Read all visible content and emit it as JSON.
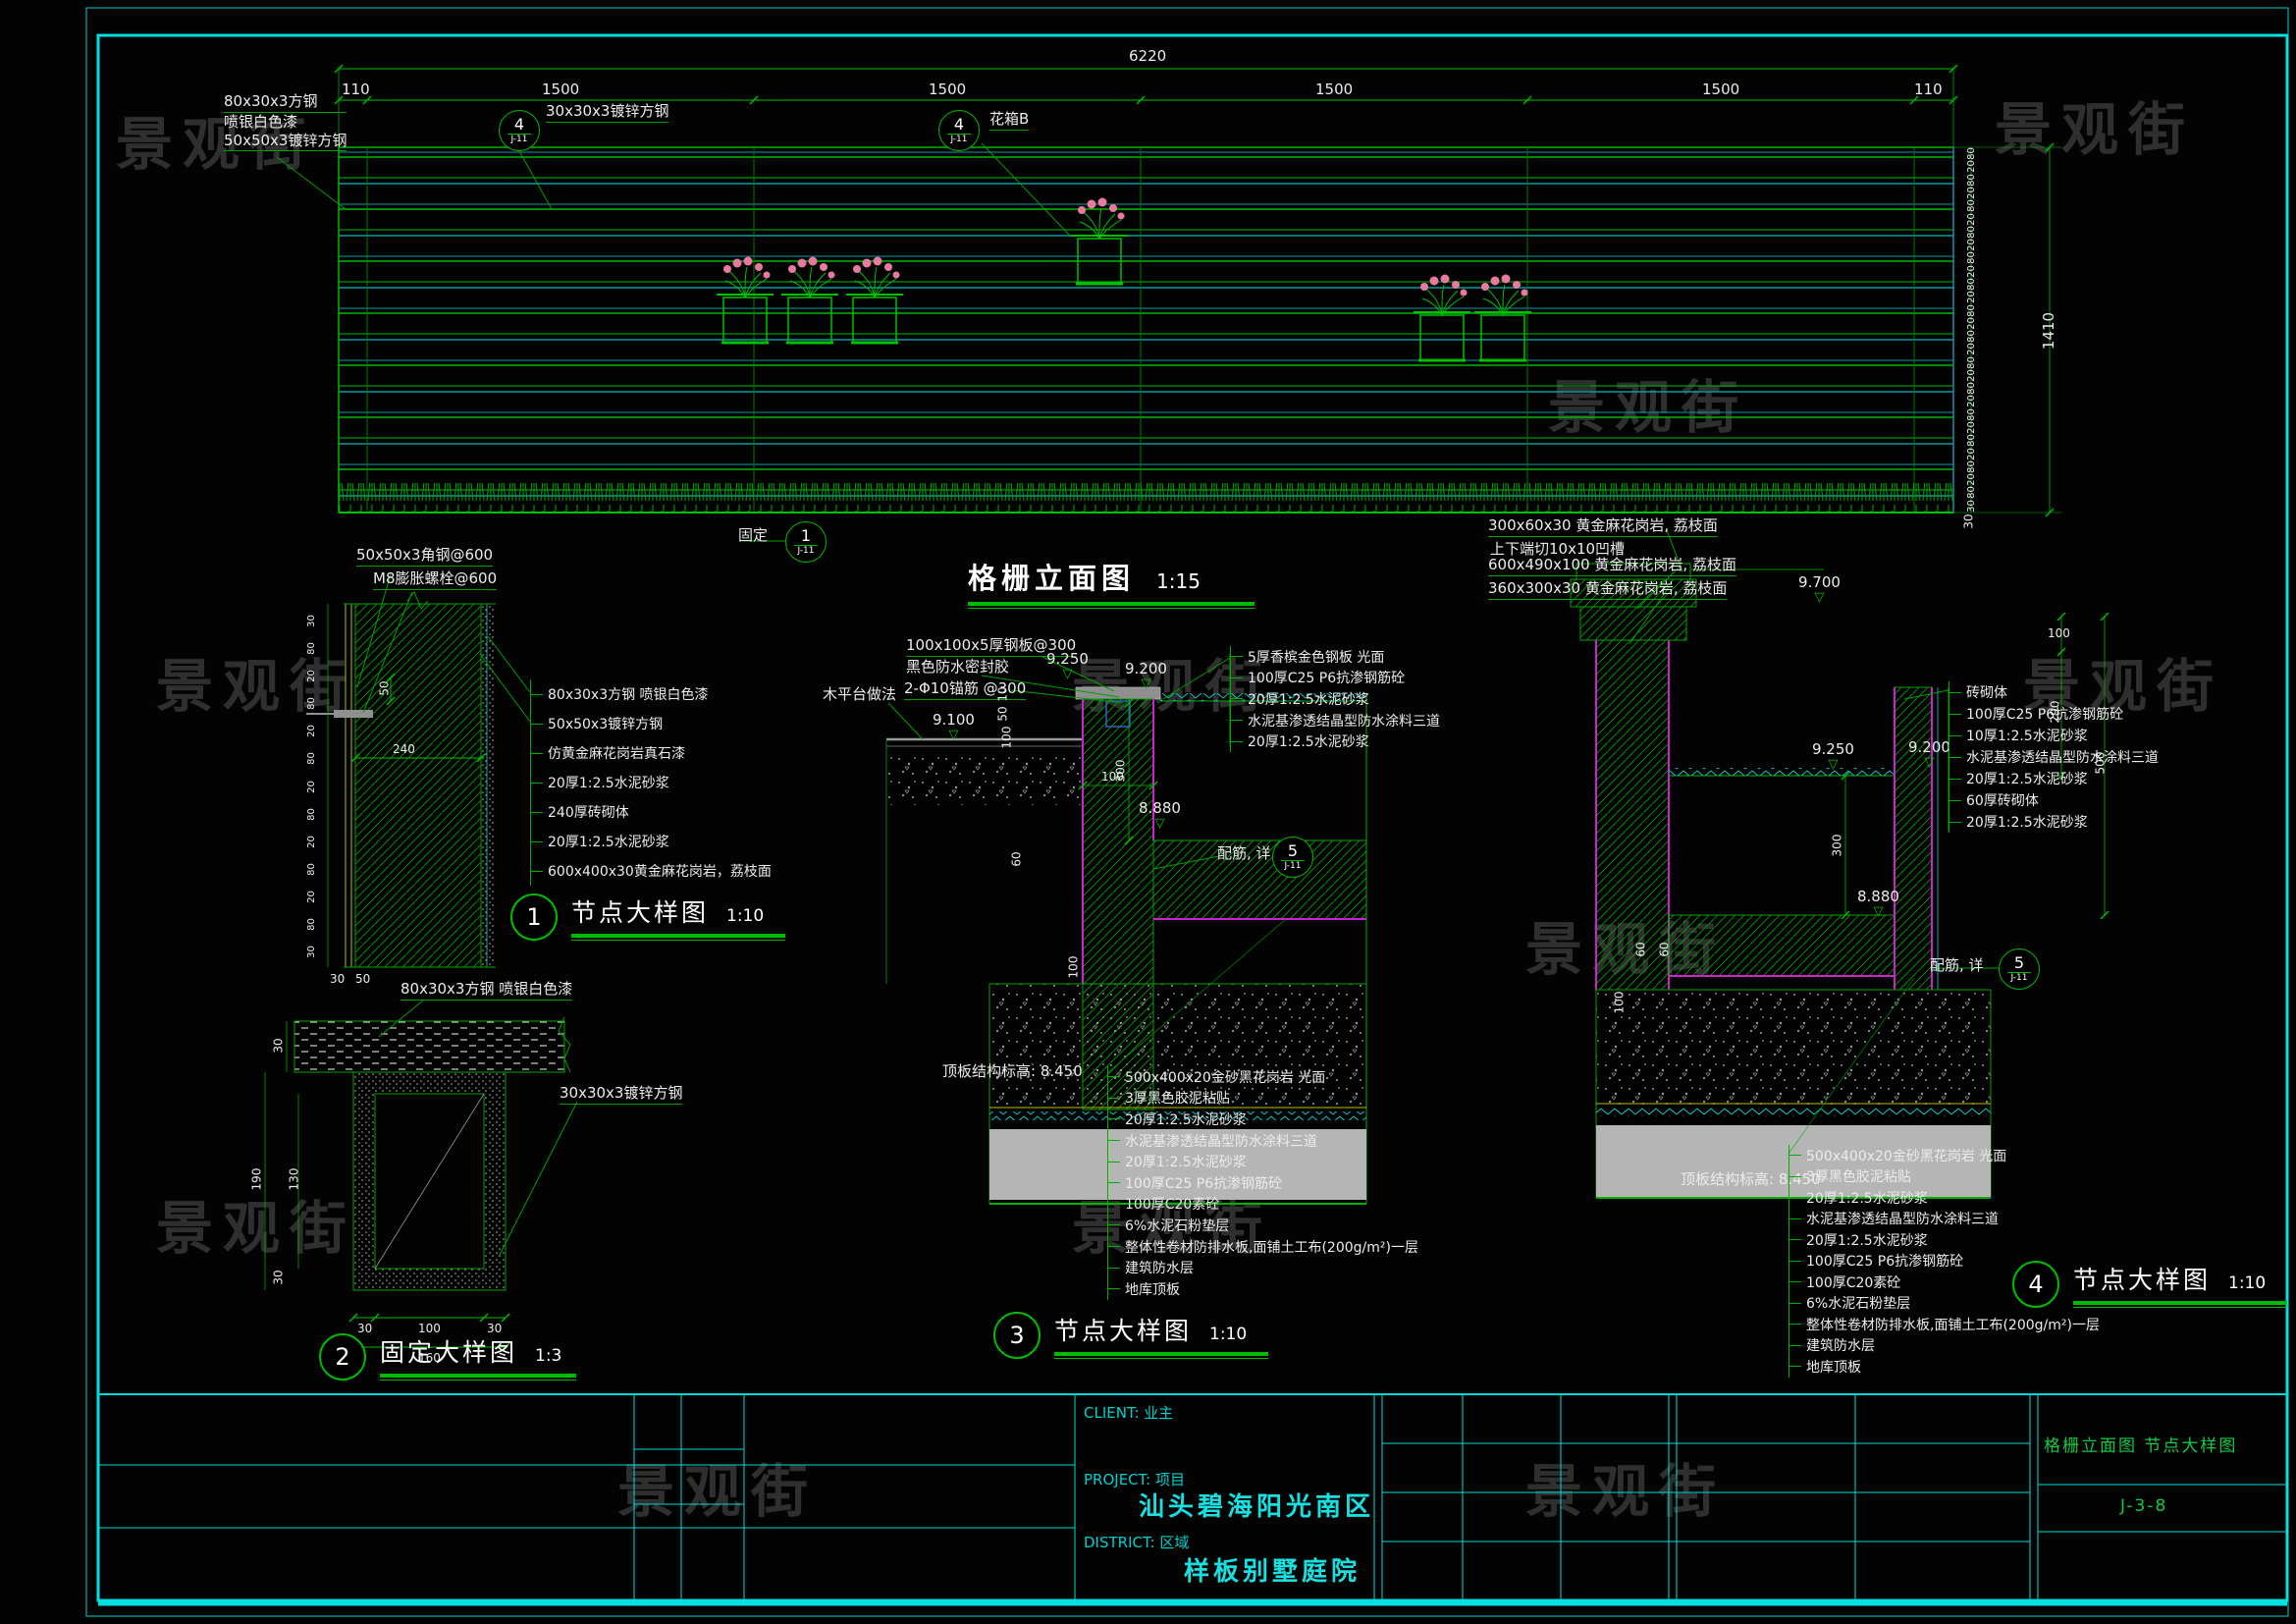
{
  "watermark": "景观街",
  "titleblock": {
    "client_label": "CLIENT: 业主",
    "project_label": "PROJECT: 项目",
    "project_name": "汕头碧海阳光南区",
    "district_label": "DISTRICT: 区域",
    "district_name": "样板别墅庭院",
    "sheet_title": "格栅立面图 节点大样图",
    "sheet_number": "J-3-8"
  },
  "elevation": {
    "title": "格栅立面图",
    "scale": "1:15",
    "dim_overall": "6220",
    "dim_segments": [
      "110",
      "1500",
      "1500",
      "1500",
      "1500",
      "110"
    ],
    "dim_right": [
      "80",
      "20",
      "80",
      "20",
      "80",
      "20",
      "80",
      "20",
      "80",
      "20",
      "80",
      "20",
      "80",
      "20",
      "80",
      "20",
      "80",
      "20",
      "80",
      "20",
      "80",
      "20",
      "80",
      "20",
      "80",
      "20",
      "80",
      "30"
    ],
    "dim_total": "1410",
    "dim_bottom": "30",
    "label_block": [
      "80x30x3方钢",
      "喷银白色漆",
      "50x50x3镀锌方钢"
    ],
    "callout_a": {
      "num": "4",
      "sheet": "J-11",
      "label": "30x30x3镀锌方钢"
    },
    "callout_b": {
      "num": "4",
      "sheet": "J-11",
      "label": "花箱B"
    },
    "fix": {
      "label": "固定",
      "num": "1",
      "sheet": "J-11"
    }
  },
  "detail1": {
    "num": "1",
    "title": "节点大样图",
    "scale": "1:10",
    "top_labels": [
      "50x50x3角钢@600",
      "M8膨胀螺栓@600"
    ],
    "layers": [
      "80x30x3方钢  喷银白色漆",
      "50x50x3镀锌方钢",
      "仿黄金麻花岗岩真石漆",
      "20厚1:2.5水泥砂浆",
      "240厚砖砌体",
      "20厚1:2.5水泥砂浆",
      "600x400x30黄金麻花岗岩，荔枝面"
    ],
    "left_dims": [
      "30",
      "80",
      "20",
      "80",
      "20",
      "80",
      "20",
      "80",
      "20",
      "80",
      "20",
      "80",
      "30"
    ],
    "dim_50": "50",
    "dim_240": "240",
    "dim_b30": "30",
    "dim_b50": "50"
  },
  "detail2": {
    "num": "2",
    "title": "固定大样图",
    "scale": "1:3",
    "label_top": "80x30x3方钢  喷银白色漆",
    "label_tube": "30x30x3镀锌方钢",
    "dims": {
      "bar": "30",
      "h": "190",
      "inner": "130",
      "wall": "30",
      "b1": "30",
      "b2": "100",
      "b3": "30",
      "total": "160"
    }
  },
  "detail3": {
    "num": "3",
    "title": "节点大样图",
    "scale": "1:10",
    "top_labels": [
      "100x100x5厚钢板@300",
      "黑色防水密封胶",
      "2-Φ10锚筋 @300"
    ],
    "deck_label": "木平台做法",
    "levels": {
      "a": "9.250",
      "b": "9.200",
      "c": "9.100",
      "d": "8.880"
    },
    "wall_layers": [
      "5厚香槟金色钢板  光面",
      "100厚C25  P6抗渗钢筋砼",
      "20厚1:2.5水泥砂浆",
      "水泥基渗透结晶型防水涂料三道",
      "20厚1:2.5水泥砂浆"
    ],
    "floor_layers": [
      "500x400x20金砂黑花岗岩  光面",
      "3厚黑色胶泥粘贴",
      "20厚1:2.5水泥砂浆",
      "水泥基渗透结晶型防水涂料三道",
      "20厚1:2.5水泥砂浆",
      "100厚C25  P6抗渗钢筋砼",
      "100厚C20素砼",
      "6%水泥石粉垫层",
      "整体性卷材防排水板,面铺土工布(200g/m²)一层",
      "建筑防水层",
      "地库顶板"
    ],
    "slab_note": "顶板结构标高: 8.450",
    "rebar_note": "配筋, 详",
    "rebar_ref": {
      "num": "5",
      "sheet": "J-11"
    },
    "dims": {
      "d10": "10",
      "d50": "50",
      "d100a": "100",
      "d100b": "100",
      "d300": "300",
      "d60": "60",
      "d100c": "100"
    }
  },
  "detail4": {
    "num": "4",
    "title": "节点大样图",
    "scale": "1:10",
    "top_labels": [
      "300x60x30  黄金麻花岗岩, 荔枝面",
      "上下端切10x10凹槽",
      "600x490x100  黄金麻花岗岩, 荔枝面",
      "360x300x30  黄金麻花岗岩, 荔枝面"
    ],
    "level_top": "9.700",
    "levels": {
      "a": "9.250",
      "b": "9.200",
      "d": "8.880"
    },
    "wall_layers": [
      "砖砌体",
      "100厚C25  P6抗渗钢筋砼",
      "10厚1:2.5水泥砂浆",
      "水泥基渗透结晶型防水涂料三道",
      "20厚1:2.5水泥砂浆",
      "60厚砖砌体",
      "20厚1:2.5水泥砂浆"
    ],
    "floor_layers": [
      "500x400x20金砂黑花岗岩  光面",
      "3厚黑色胶泥粘贴",
      "20厚1:2.5水泥砂浆",
      "水泥基渗透结晶型防水涂料三道",
      "20厚1:2.5水泥砂浆",
      "100厚C25  P6抗渗钢筋砼",
      "100厚C20素砼",
      "6%水泥石粉垫层",
      "整体性卷材防排水板,面铺土工布(200g/m²)一层",
      "建筑防水层",
      "地库顶板"
    ],
    "slab_note": "顶板结构标高: 8.450",
    "rebar_note": "配筋, 详",
    "rebar_ref": {
      "num": "5",
      "sheet": "J-11"
    },
    "dims": {
      "d100a": "100",
      "d290": "290",
      "d500": "500",
      "d300": "300",
      "d60a": "60",
      "d60b": "60",
      "d100b": "100"
    }
  }
}
